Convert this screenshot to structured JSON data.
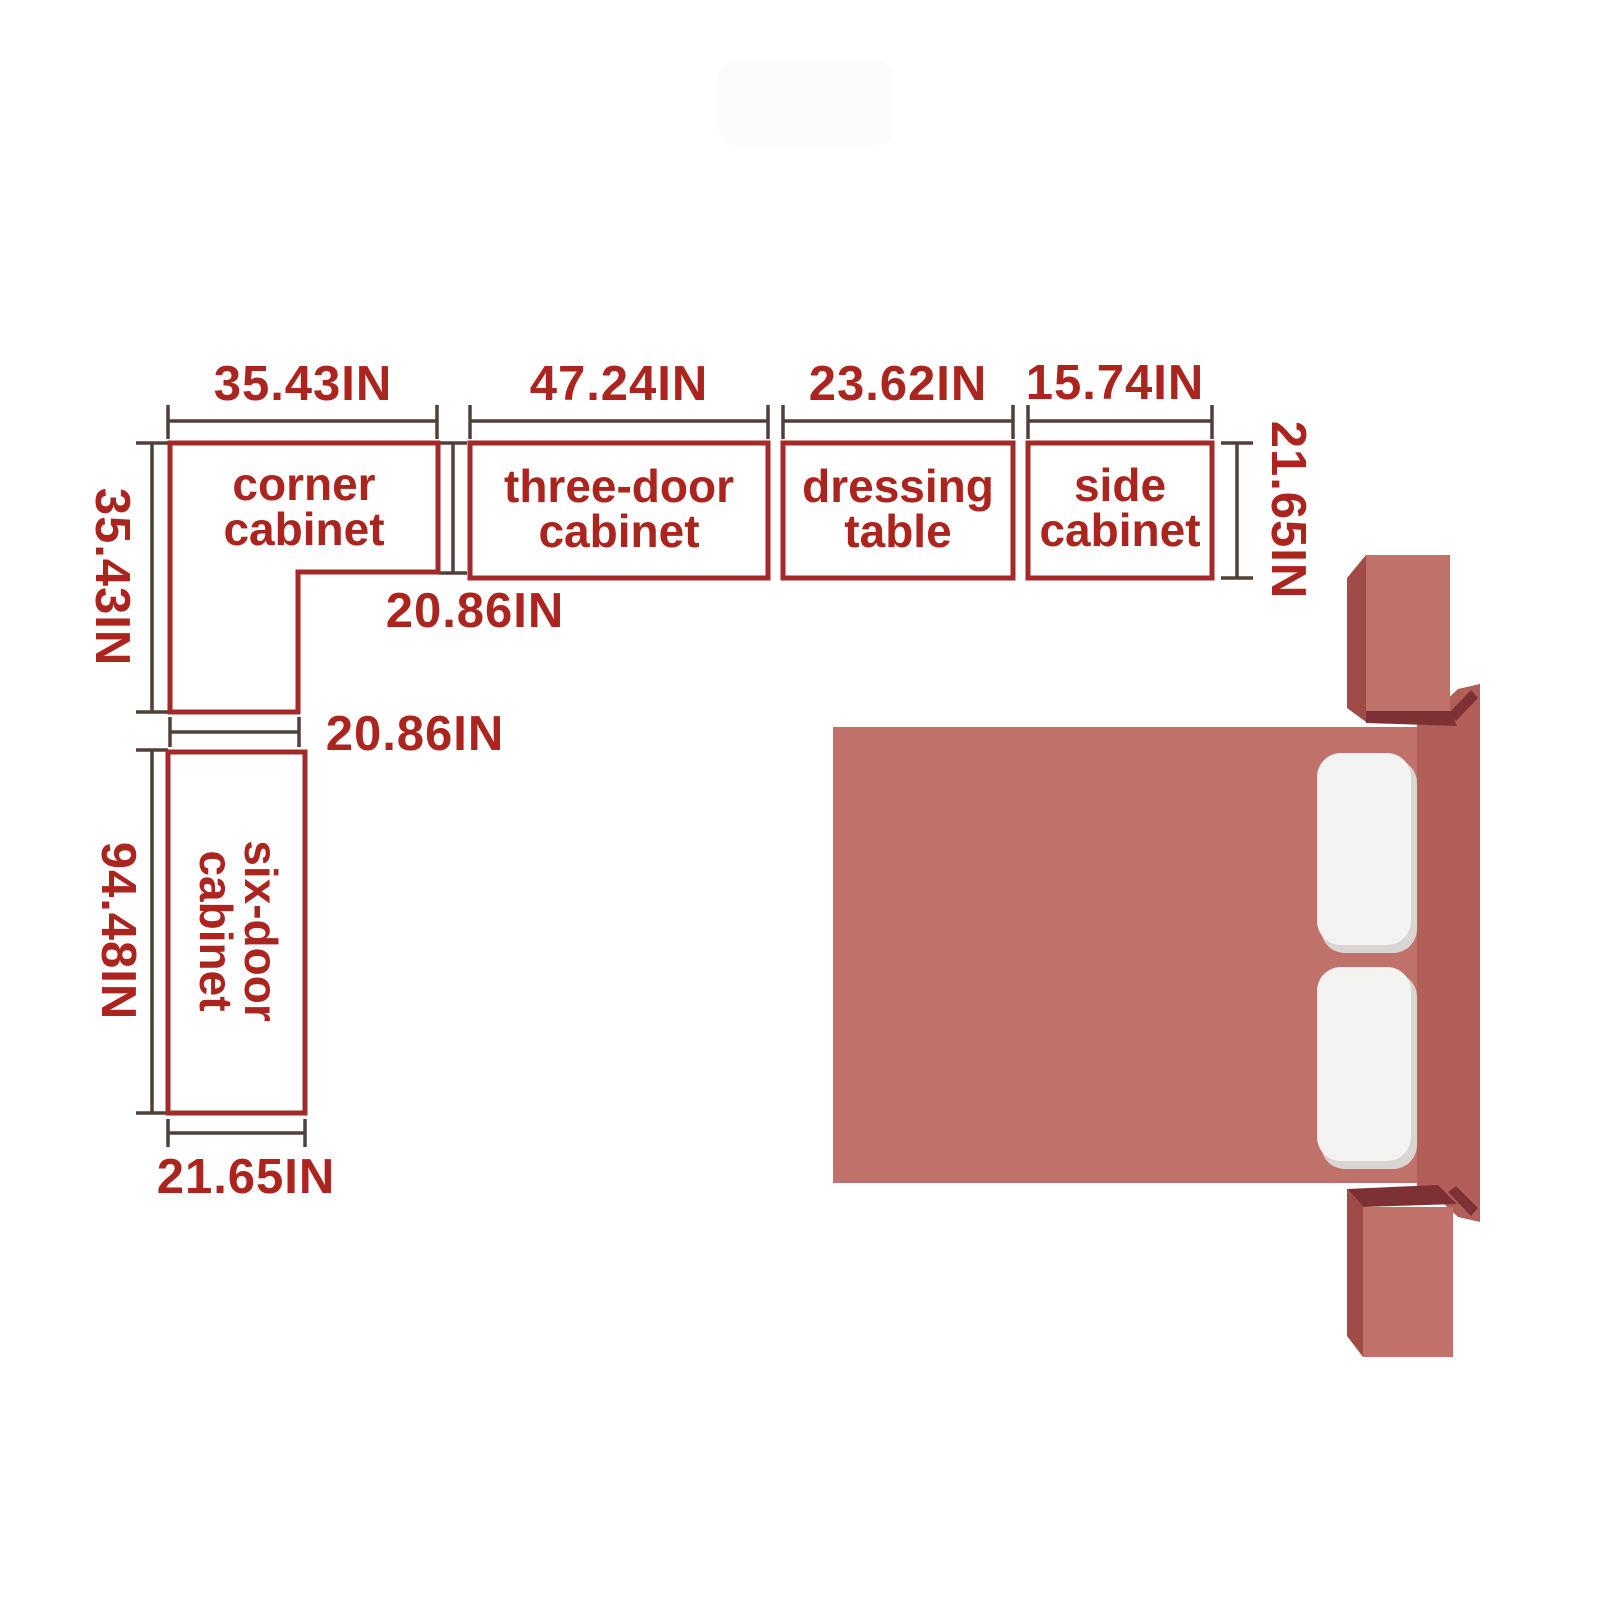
{
  "colors": {
    "outline_red": "#a32a28",
    "text_red": "#ab241e",
    "dim_line": "#51403a",
    "bed_main": "#c07169",
    "bed_headboard": "#b25f5a",
    "bed_side_dark": "#a04b47",
    "bed_shadow": "#7e3134",
    "pillow": "#f3f3f2",
    "pillow_shadow": "#d9d5d2",
    "watermark": "#fcfcfc"
  },
  "cabinets": {
    "corner": {
      "name": [
        "corner",
        "cabinet"
      ],
      "top_width": "35.43IN",
      "left_height": "35.43IN",
      "inner_depth": "20.86IN",
      "bottom_width": "20.86IN"
    },
    "three_door": {
      "name": [
        "three-door",
        "cabinet"
      ],
      "width": "47.24IN"
    },
    "dressing_table": {
      "name": [
        "dressing",
        "table"
      ],
      "width": "23.62IN"
    },
    "side_cabinet": {
      "name": [
        "side",
        "cabinet"
      ],
      "width": "15.74IN"
    },
    "top_row_depth": "21.65IN",
    "six_door": {
      "name": [
        "six-door",
        "cabinet"
      ],
      "height": "94.48IN",
      "width": "21.65IN"
    }
  }
}
